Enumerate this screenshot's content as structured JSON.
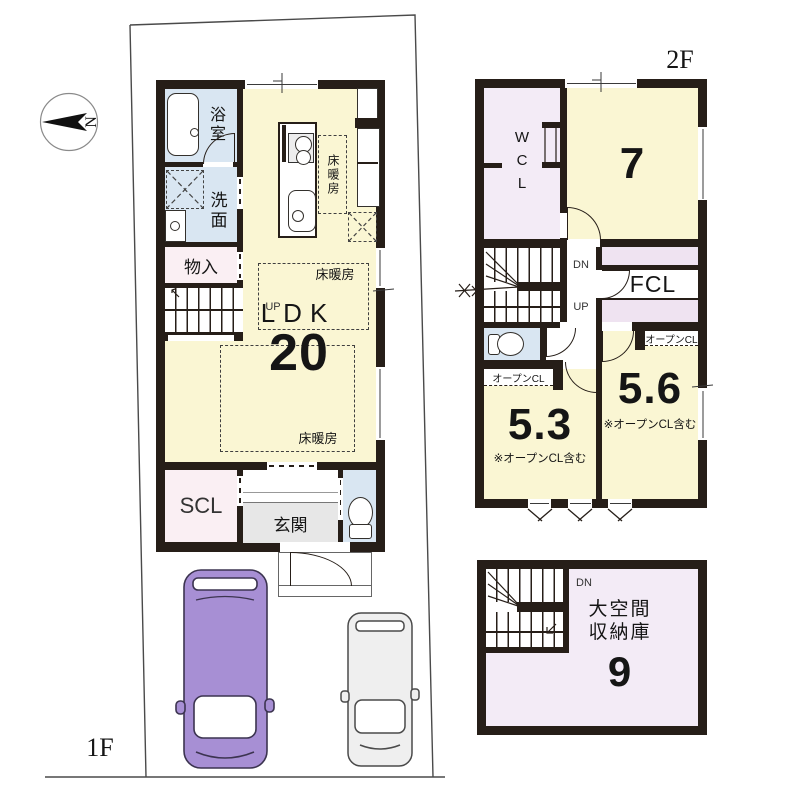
{
  "plan": {
    "floor1_label": "1F",
    "floor2_label": "2F",
    "compass_letter": "N",
    "floor1": {
      "bath": "浴室",
      "washroom": "洗面",
      "closet": "物入",
      "up": "UP",
      "ldk_label": "LDK",
      "ldk_size": "20",
      "floor_heating": "床暖房",
      "shoe_closet": "SCL",
      "entrance": "玄関"
    },
    "floor2": {
      "walkin_closet": "WCL",
      "room7_size": "7",
      "family_closet": "FCL",
      "down": "DN",
      "up": "UP",
      "open_closet": "オープンCL",
      "room53_size": "5.3",
      "room56_size": "5.6",
      "open_closet_note": "※オープンCL含む"
    },
    "attic": {
      "name_line1": "大空間",
      "name_line2": "収納庫",
      "size": "9",
      "down": "DN"
    },
    "colors": {
      "wall": "#261E18",
      "room_yellow": "#FAF6D3",
      "room_blue": "#D9E6F2",
      "room_lavender": "#F3EBF6",
      "room_pink": "#FAEFF3",
      "entrance_gray": "#E7E7E7",
      "car_purple": "#A78FD4",
      "car_gray": "#EFEFEF"
    }
  }
}
